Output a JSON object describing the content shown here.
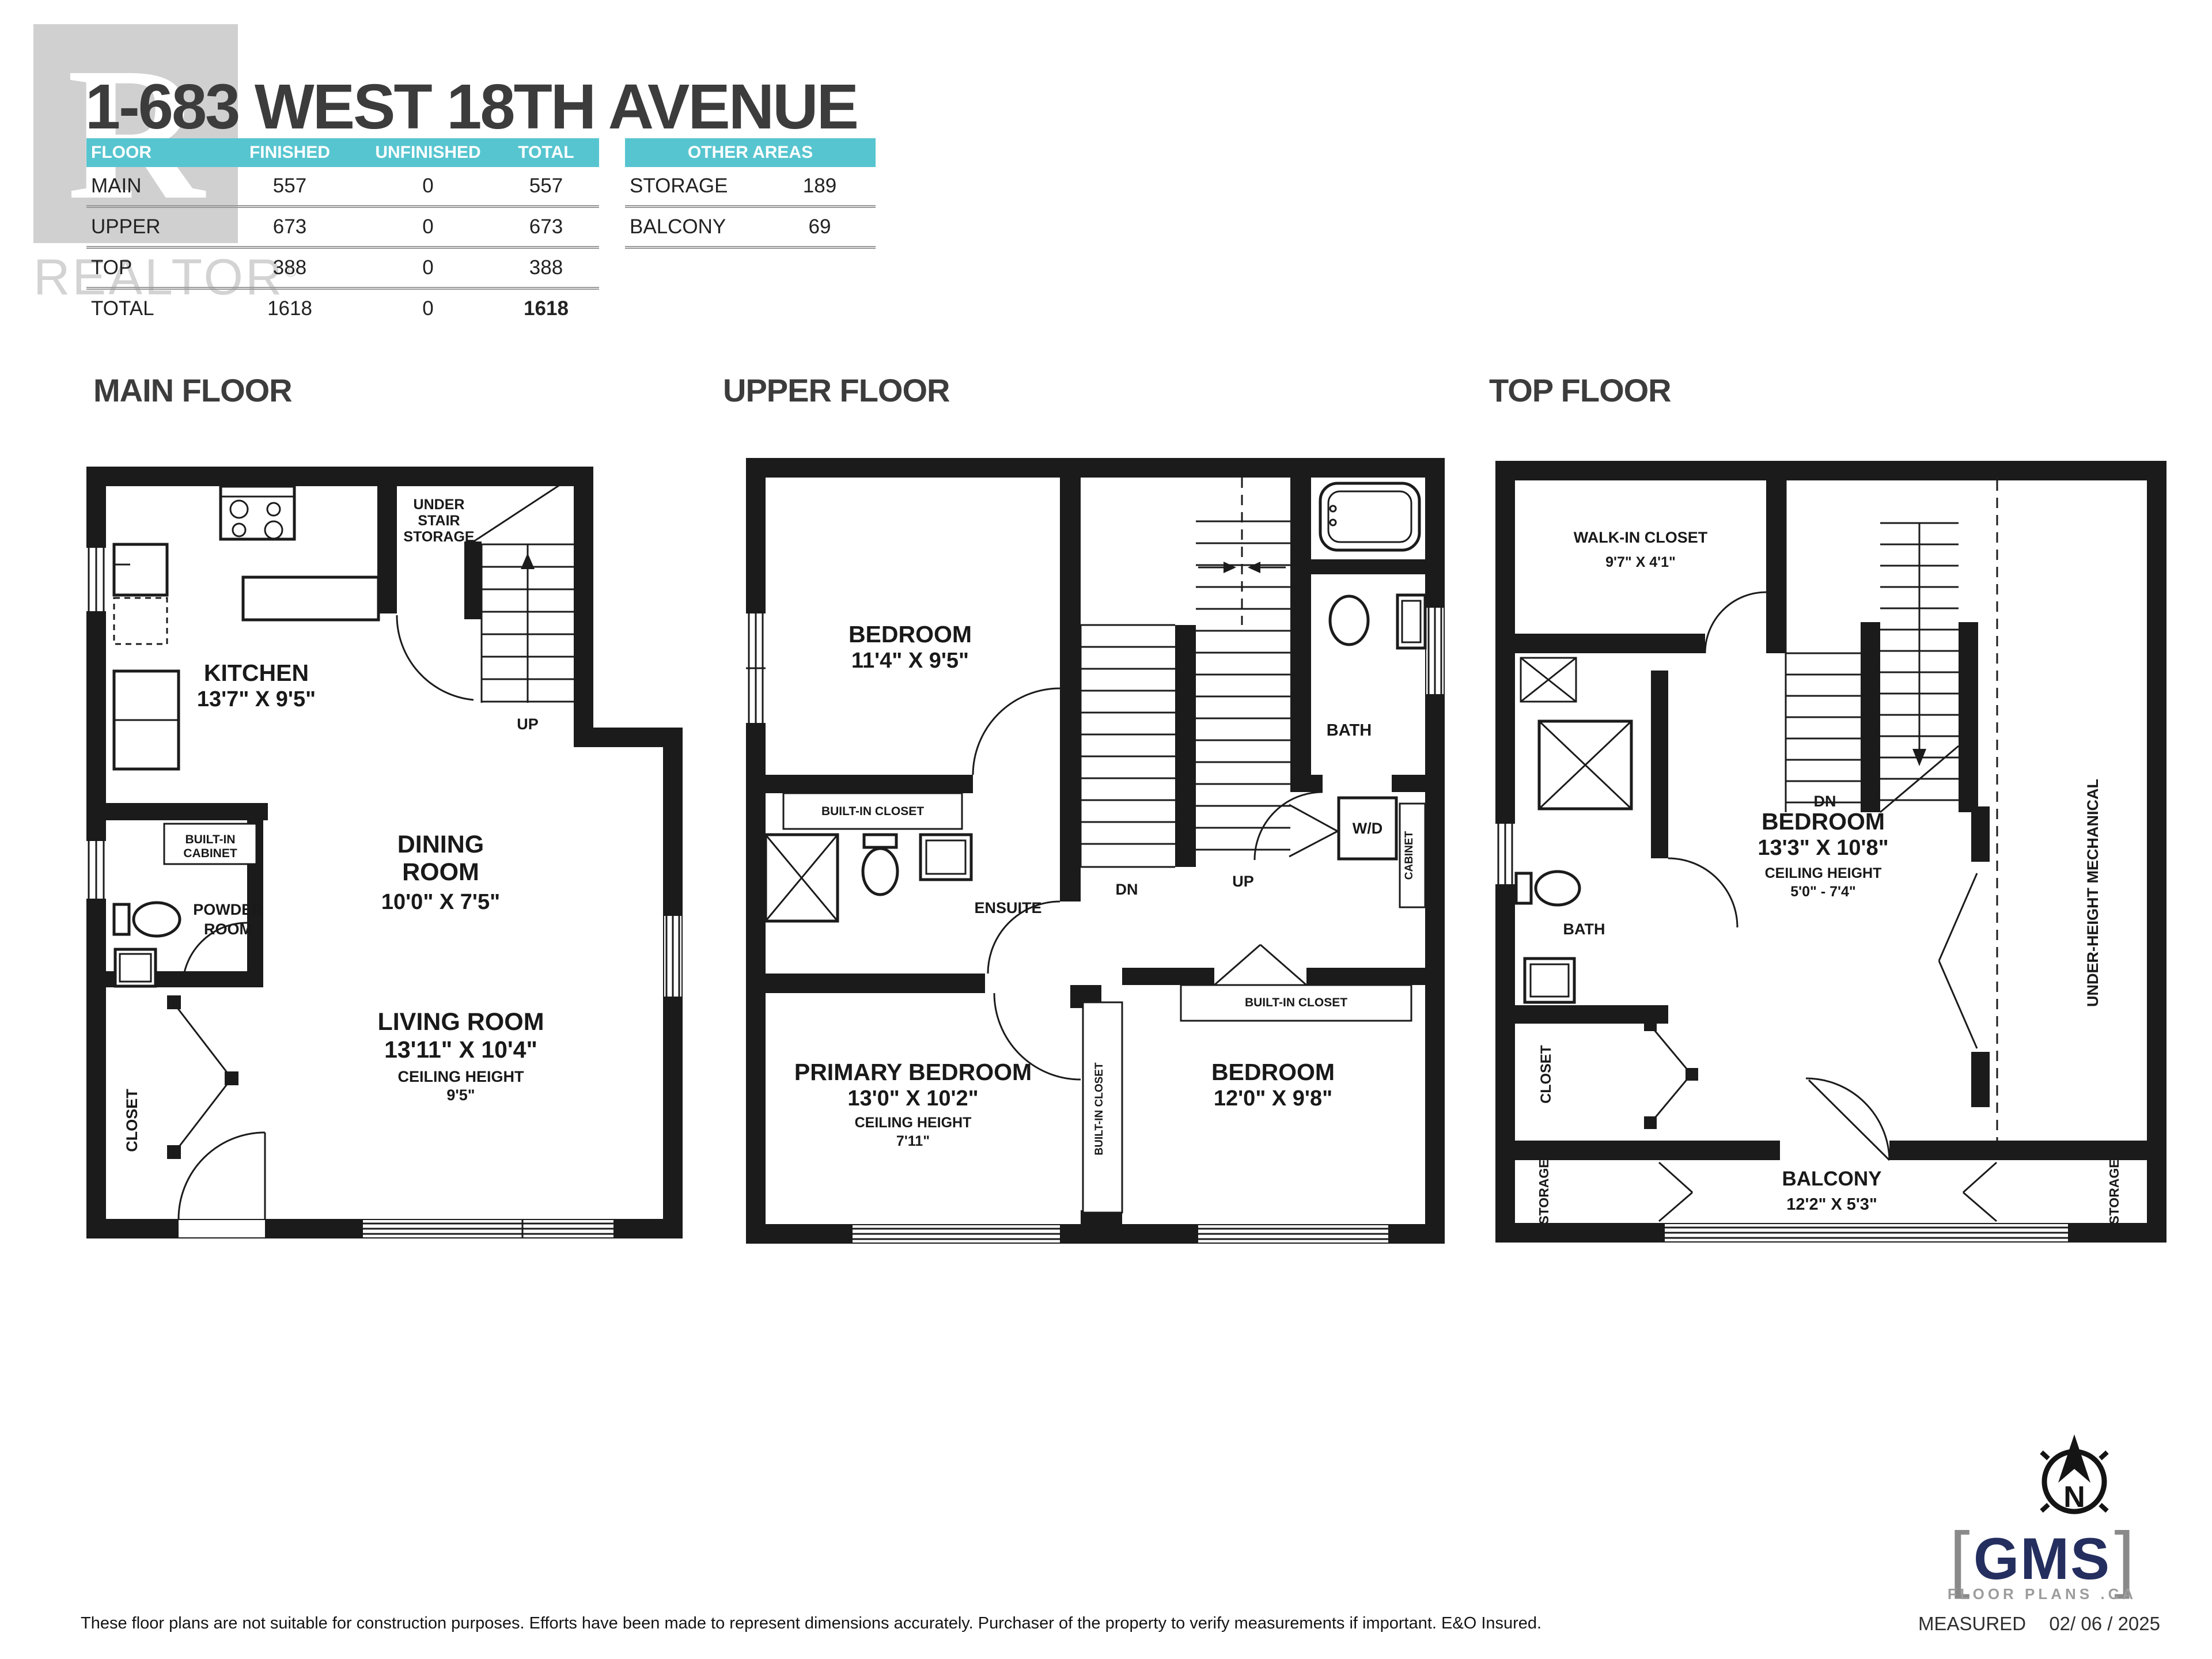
{
  "colors": {
    "accent": "#57c5d0",
    "wall": "#1b1b1b",
    "title": "#3c3c3c",
    "logo-navy": "#242e5f",
    "logo-gray": "#9c9c9c",
    "wm": "#b0b0b0"
  },
  "header": {
    "title": "1-683 WEST 18TH AVENUE",
    "watermark": {
      "letter": "R",
      "word": "REALTOR",
      "reg": "®"
    },
    "area_table": {
      "columns": [
        "FLOOR",
        "FINISHED",
        "UNFINISHED",
        "TOTAL"
      ],
      "rows": [
        [
          "MAIN",
          "557",
          "0",
          "557"
        ],
        [
          "UPPER",
          "673",
          "0",
          "673"
        ],
        [
          "TOP",
          "388",
          "0",
          "388"
        ],
        [
          "TOTAL",
          "1618",
          "0",
          "1618"
        ]
      ]
    },
    "other_areas": {
      "title": "OTHER AREAS",
      "rows": [
        [
          "STORAGE",
          "189"
        ],
        [
          "BALCONY",
          "69"
        ]
      ]
    }
  },
  "floors": {
    "main": {
      "title": "MAIN FLOOR",
      "labels": {
        "kitchen": [
          "KITCHEN",
          "13'7\" X 9'5\""
        ],
        "under_stair": [
          "UNDER",
          "STAIR",
          "STORAGE"
        ],
        "up": "UP",
        "dining": [
          "DINING",
          "ROOM",
          "10'0\" X 7'5\""
        ],
        "built_in_cabinet": [
          "BUILT-IN",
          "CABINET"
        ],
        "powder": [
          "POWDER",
          "ROOM"
        ],
        "closet": "CLOSET",
        "living": [
          "LIVING ROOM",
          "13'11\" X 10'4\"",
          "CEILING HEIGHT",
          "9'5\""
        ]
      }
    },
    "upper": {
      "title": "UPPER FLOOR",
      "labels": {
        "bedroom1": [
          "BEDROOM",
          "11'4\" X 9'5\""
        ],
        "dn": "DN",
        "up": "UP",
        "bath": "BATH",
        "built_in_closet": "BUILT-IN CLOSET",
        "ensuite": "ENSUITE",
        "cabinet": "CABINET",
        "wd": "W/D",
        "primary": [
          "PRIMARY BEDROOM",
          "13'0\" X 10'2\"",
          "CEILING HEIGHT",
          "7'11\""
        ],
        "bedroom2": [
          "BEDROOM",
          "12'0\" X 9'8\""
        ]
      }
    },
    "top": {
      "title": "TOP FLOOR",
      "labels": {
        "walk_in_closet": [
          "WALK-IN CLOSET",
          "9'7\" X 4'1\""
        ],
        "dn": "DN",
        "bath": "BATH",
        "bedroom": [
          "BEDROOM",
          "13'3\" X 10'8\"",
          "CEILING HEIGHT",
          "5'0\" - 7'4\""
        ],
        "closet": "CLOSET",
        "storage": "STORAGE",
        "balcony": [
          "BALCONY",
          "12'2\" X 5'3\""
        ],
        "mechanical": "UNDER-HEIGHT MECHANICAL"
      }
    }
  },
  "footer": {
    "disclaimer": "These floor plans are not suitable for construction purposes. Efforts have been made to represent dimensions accurately.  Purchaser of the property to verify measurements if important.  E&O Insured.",
    "measured_label": "MEASURED",
    "measured_date": "02/ 06 / 2025",
    "compass_n": "N",
    "logo": {
      "bracket_l": "[",
      "name": "GMS",
      "bracket_r": "]",
      "tagline": "FLOOR PLANS .CA"
    }
  }
}
